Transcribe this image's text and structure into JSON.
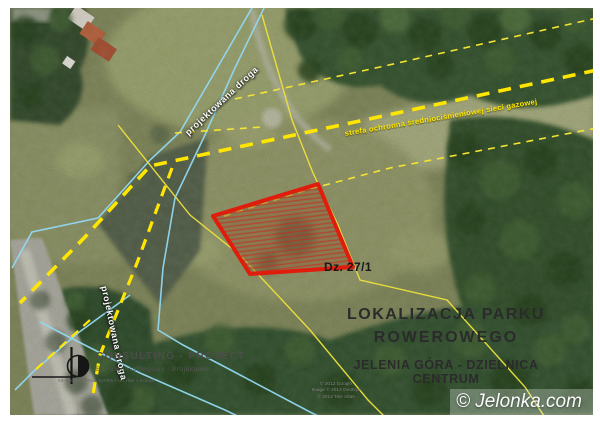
{
  "map": {
    "title_line1": "LOKALIZACJA PARKU",
    "title_line2": "ROWEROWEGO",
    "subtitle": "JELENIA GÓRA - DZIELNICA CENTRUM",
    "parcel_label": "Dz. 27/1",
    "road_label_top": "projektowana droga",
    "road_label_bottom": "projektowana droga",
    "gas_zone_label": "strefa ochronna średniociśnieniowej sieci gazowej"
  },
  "logo": {
    "company": "CONSULTING - PROJECT",
    "tagline": "Biuro Konsultingowo - Projektowe",
    "microtext": "58-500 JELENIA GÓRA  •  tel./fax  •  e-mail"
  },
  "attribution": {
    "line1": "© 2012 Google",
    "line2": "Image © 2012 GeoEye",
    "line3": "© 2012 Tele Atlas",
    "watermark": "© Jelonka.com"
  },
  "colors": {
    "parcel_outline": "#e01c0c",
    "boundary_line": "#92d8f0",
    "gas_line": "#ffe600",
    "title_text": "#2b2b2b"
  }
}
